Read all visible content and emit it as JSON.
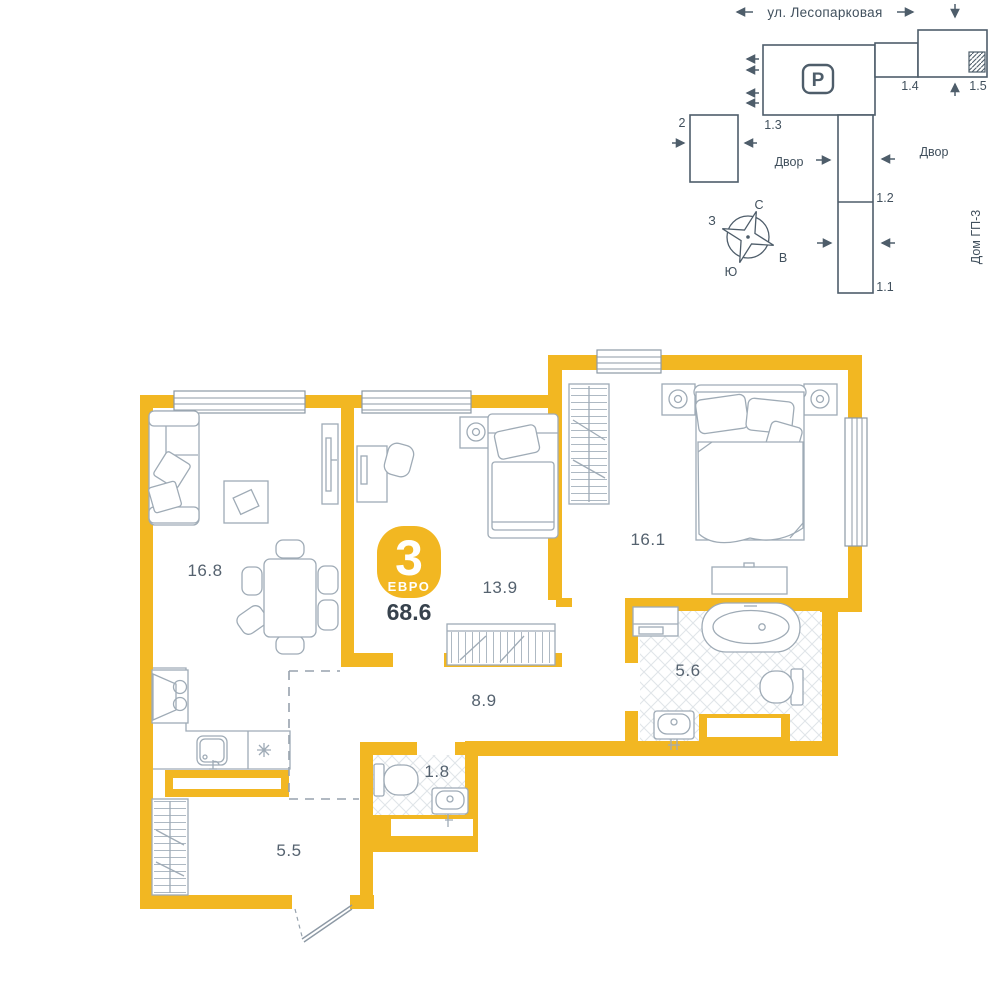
{
  "colors": {
    "accent": "#F2B722",
    "furniture_line": "#9FABB6",
    "site_line": "#4E5D6A",
    "text_dark": "#37424D",
    "room_label": "#55626F",
    "tile": "#E0E5E9",
    "window_frame": "#8D99A5"
  },
  "site_plan": {
    "street": "ул. Лесопарковая",
    "yard_left": "Двор",
    "yard_right": "Двор",
    "house_label": "Дом ГП-3",
    "parking_icon": "P",
    "buildings": {
      "b2": "2",
      "b13": "1.3",
      "b14": "1.4",
      "b15": "1.5",
      "b12": "1.2",
      "b11": "1.1"
    },
    "compass": {
      "n": "С",
      "s": "Ю",
      "w": "З",
      "e": "В"
    }
  },
  "plan": {
    "badge": {
      "rooms": "3",
      "type": "ЕВРО"
    },
    "total_area": "68.6",
    "rooms": [
      {
        "id": "living",
        "area": "16.8"
      },
      {
        "id": "bedroom-2",
        "area": "13.9"
      },
      {
        "id": "bedroom-1",
        "area": "16.1"
      },
      {
        "id": "bathroom",
        "area": "5.6"
      },
      {
        "id": "hallway",
        "area": "8.9"
      },
      {
        "id": "wc",
        "area": "1.8"
      },
      {
        "id": "entry",
        "area": "5.5"
      }
    ]
  }
}
